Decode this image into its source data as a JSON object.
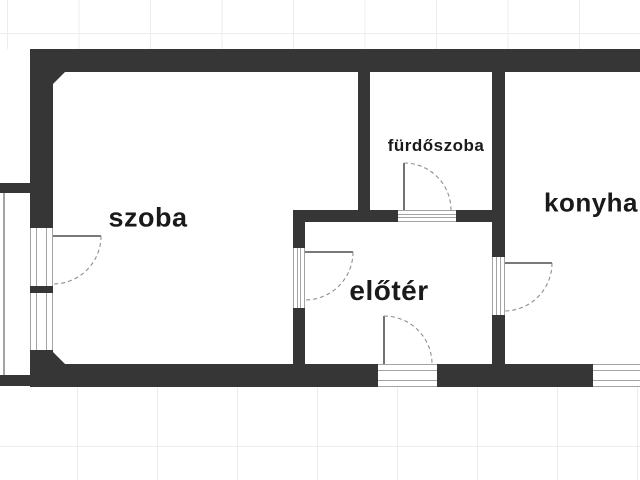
{
  "title": "apartment floor plan",
  "colors": {
    "wall": "#363636",
    "background": "#ffffff",
    "grid_line": "#ececec",
    "sill_line": "#a3a3a3",
    "door_arc": "#8f8f8f",
    "door_panel": "#4d4d4d",
    "label_text": "#1a1a1a"
  },
  "rooms": {
    "szoba": {
      "label": "szoba"
    },
    "furdoszoba": {
      "label": "fürdőszoba"
    },
    "eloter": {
      "label": "előtér"
    },
    "konyha": {
      "label": "konyha"
    }
  },
  "features": {
    "doors": [
      "balcony-door-szoba",
      "door-szoba-to-eloter",
      "door-furdoszoba",
      "entry-door-eloter",
      "door-eloter-to-konyha"
    ],
    "windows": [
      "balcony-window-szoba",
      "window-konyha-bottom"
    ],
    "balcony": "balcony-left"
  }
}
